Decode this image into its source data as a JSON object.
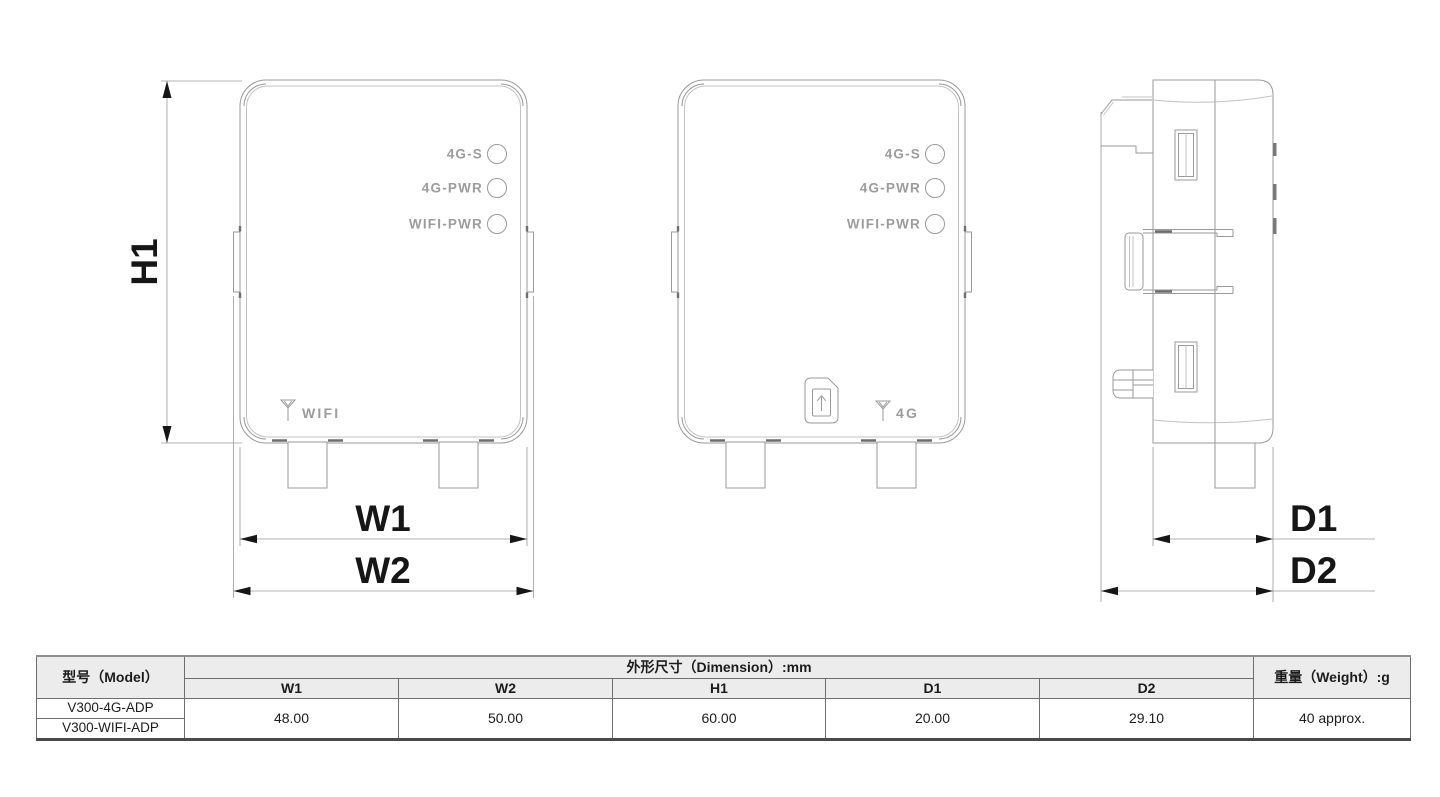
{
  "diagram": {
    "dims": {
      "h1": "H1",
      "w1": "W1",
      "w2": "W2",
      "d1": "D1",
      "d2": "D2"
    },
    "views": {
      "front_wifi": {
        "led_labels": [
          "4G-S",
          "4G-PWR",
          "WIFI-PWR"
        ],
        "port_label": "WIFI"
      },
      "front_4g": {
        "led_labels": [
          "4G-S",
          "4G-PWR",
          "WIFI-PWR"
        ],
        "port_label": "4G"
      }
    }
  },
  "table": {
    "model_header": "型号（Model）",
    "dimension_header": "外形尺寸（Dimension）:mm",
    "weight_header": "重量（Weight）:g",
    "dim_columns": [
      "W1",
      "W2",
      "H1",
      "D1",
      "D2"
    ],
    "models": [
      "V300-4G-ADP",
      "V300-WIFI-ADP"
    ],
    "values": [
      "48.00",
      "50.00",
      "60.00",
      "20.00",
      "29.10"
    ],
    "weight_value": "40 approx."
  },
  "colors": {
    "drawing_line": "#9a9a9a",
    "dimension_text": "#161616",
    "engraved_text": "#9c9c9c",
    "table_header_bg": "#ececec"
  }
}
